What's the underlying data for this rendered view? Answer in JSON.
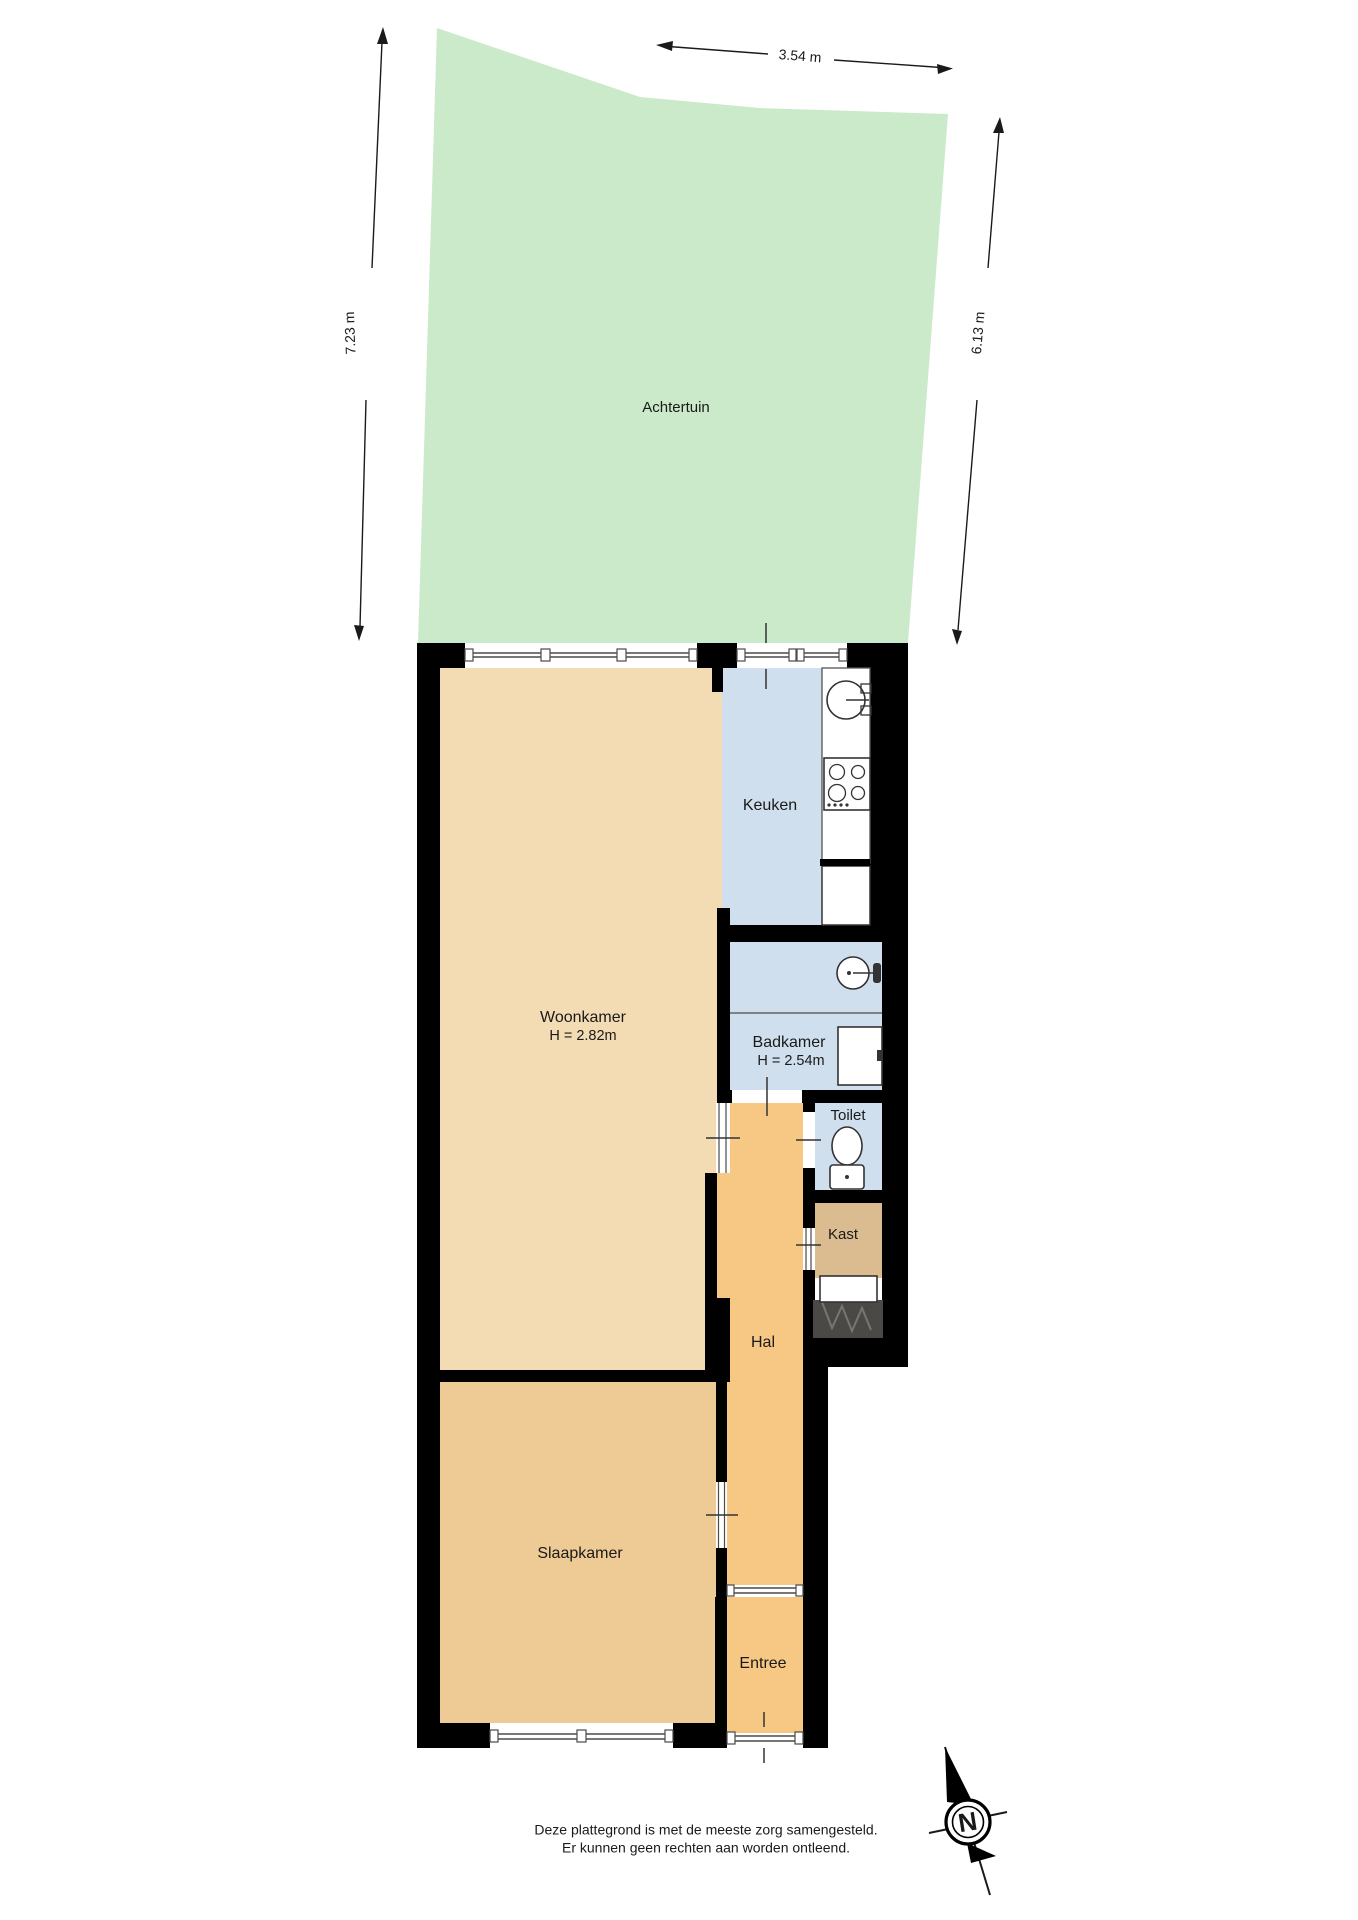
{
  "plan": {
    "garden": {
      "label": "Achtertuin"
    },
    "rooms": {
      "keuken": {
        "label": "Keuken"
      },
      "woonkamer": {
        "label": "Woonkamer",
        "height": "H = 2.82m"
      },
      "badkamer": {
        "label": "Badkamer",
        "height": "H = 2.54m"
      },
      "toilet": {
        "label": "Toilet"
      },
      "kast": {
        "label": "Kast"
      },
      "hal": {
        "label": "Hal"
      },
      "slaapkamer": {
        "label": "Slaapkamer"
      },
      "entree": {
        "label": "Entree"
      }
    },
    "dimensions": {
      "top": "3.54 m",
      "left": "7.23 m",
      "right": "6.13 m"
    },
    "compass": {
      "north_label": "N"
    },
    "footer": {
      "line1": "Deze plattegrond is met de meeste zorg samengesteld.",
      "line2": "Er kunnen geen rechten aan worden ontleend."
    },
    "colors": {
      "garden": "#cbeac9",
      "woonkamer": "#f3dcb4",
      "slaapkamer": "#eeca94",
      "hal": "#f7c884",
      "entree": "#f7c884",
      "kast": "#dbbc90",
      "wet_rooms": "#cfdfee",
      "badkamer": "#cfdfee",
      "toilet": "#cfdfee",
      "wall": "#000000",
      "stairs": "#4a4946"
    }
  }
}
